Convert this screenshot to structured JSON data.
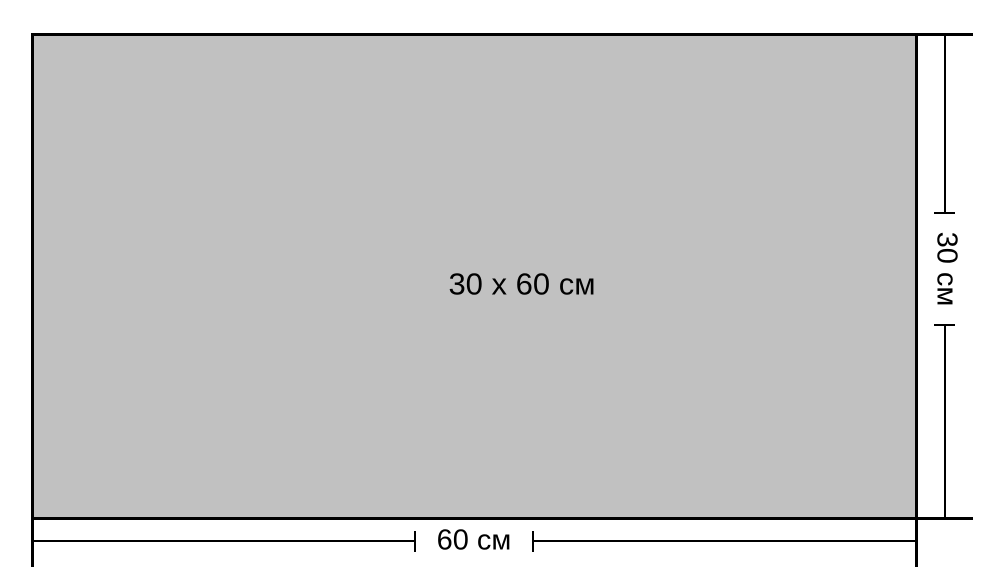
{
  "diagram": {
    "size_label": "30 x 60 см",
    "width_label": "60 см",
    "height_label": "30 см"
  },
  "colors": {
    "fill": "#c1c1c1",
    "line": "#000000",
    "background": "#ffffff"
  }
}
